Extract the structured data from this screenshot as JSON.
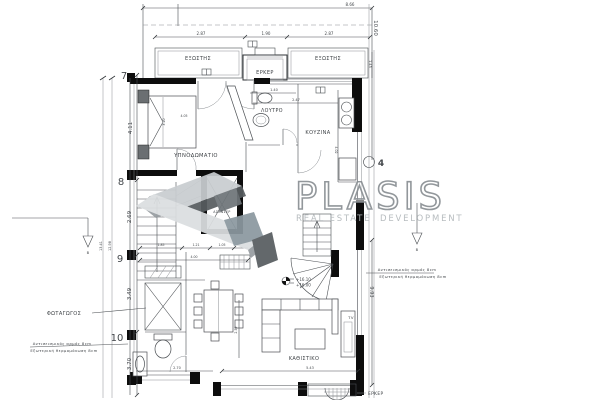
{
  "colors": {
    "paper": "#ffffff",
    "wall_black": "#0d0d0d",
    "line_grey": "#4a4e52",
    "logo_wordmark_stroke": "#8a9094",
    "logo_tagline": "#b2b8bb",
    "logo_mark_light": "#c9cdd0",
    "logo_mark_pale": "#dbdee0",
    "logo_mark_mid": "#979da1",
    "logo_mark_dark": "#585d60",
    "logo_mark_blue": "#8b98a0"
  },
  "logo": {
    "wordmark": "PLASIS",
    "tagline_left": "REAL ESTATE",
    "tagline_right": "DEVELOPMENT"
  },
  "rooms": {
    "bedroom": "ΥΠΝΟΔΩΜΑΤΙΟ",
    "bathroom": "ΛΟΥΤΡΟ",
    "kitchen": "ΚΟΥΖΙΝΑ",
    "living_room": "ΚΑΘΙΣΤΙΚΟ",
    "light_well": "ΦΩΤΑΓΩΓΟΣ",
    "balcony_left": "ΕΞΩΣΤΗΣ",
    "balcony_right": "ΕΞΩΣΤΗΣ",
    "bay_window_top": "ΕΡΚΕΡ",
    "bay_window_bottom": "ΕΡΚΕΡ",
    "elevator": "ΑΣΑΝΣΕΡ",
    "tv": "TV"
  },
  "grid_markers": {
    "m7": "7",
    "m8": "8",
    "m9": "9",
    "m10": "10",
    "m4": "4"
  },
  "levels": {
    "upper": "+16.10",
    "lower": "+16.00"
  },
  "annotations": {
    "seismic_joint": "Αντισεισμικός αρμός 8cm",
    "thermal_insulation": "Εξωτερική θερμομόνωση 8cm",
    "benchmark": "B"
  },
  "dimensions": {
    "top_total": "8.66",
    "top_left": "2.87",
    "top_center": "1.90",
    "top_right": "2.87",
    "right_upper": "10.60",
    "right_upper_small": "1.45",
    "right_lower": "9.93",
    "left_7_8": "4.11",
    "left_8_9": "2.69",
    "left_9_10": "3.49",
    "left_10_end": "3.70",
    "left_total_outer": "13.41",
    "left_total_inner": "12.98",
    "bathroom_width": "1.40",
    "kitchen_width": "2.47",
    "kitchen_depth": "4.02",
    "bedroom_width": "4.05",
    "bedroom_depth": "3.20",
    "stair_a": "1.85",
    "stair_b": "1.21",
    "stair_c": "1.05",
    "hall_total": "4.00",
    "bottom_left": "2.70",
    "bottom_right": "5.43",
    "dining_depth": "2.59"
  }
}
